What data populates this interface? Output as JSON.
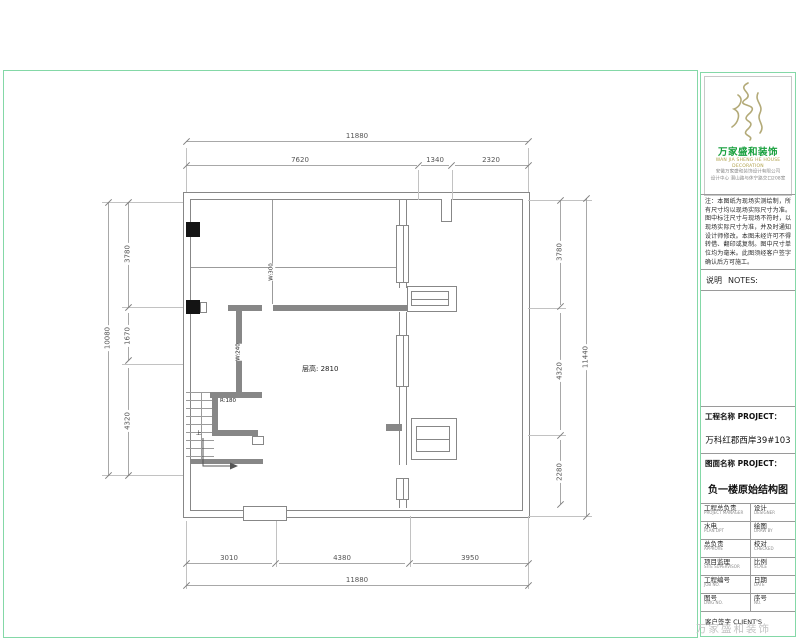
{
  "plan": {
    "dims": {
      "top_total": "11880",
      "top_segs": [
        "7620",
        "1340",
        "2320"
      ],
      "bottom_segs": [
        "3010",
        "4380",
        "3950"
      ],
      "bottom_total": "11880",
      "left_total": "10080",
      "left_segs": [
        "3780",
        "1670",
        "4320"
      ],
      "right_segs": [
        "3780",
        "4320",
        "2280"
      ],
      "right_total": "11440"
    },
    "labels": {
      "floor_height": "层高: 2810",
      "wall_300": "W:300",
      "wall_240": "W:240",
      "stair_rise": "R:180",
      "up": "上"
    }
  },
  "panel": {
    "brand_cn": "万家盛和装饰",
    "brand_en": "WAN JIA SHENG HE HOUSE DECORATION",
    "company_line1": "安徽万家盛和装饰设计有限公司",
    "company_line2": "设计中心 潜山路与休宁路交口208室",
    "notes": "注：本图纸为现场实测绘制，所有尺寸均以现场实际尺寸为准。图中标注尺寸与现场不符时，以现场实际尺寸为准，并及时通知设计师修改。本图未经许可不得转借、翻印或复制。图中尺寸单位均为毫米。此图须经客户签字确认后方可施工。",
    "notes_cn": "说明",
    "notes_en": "NOTES:",
    "project_label": "工程名称 PROJECT：",
    "project_name": "万科红郡西岸39#103",
    "drawing_label": "图面名称 PROJECT：",
    "drawing_name": "负一楼原始结构图",
    "table_rows": [
      {
        "l_cn": "工程总负责",
        "l_en": "PROJECT MANAGER",
        "r_cn": "设计",
        "r_en": "DESIGNER"
      },
      {
        "l_cn": "水电",
        "l_en": "PLAN DPT",
        "r_cn": "绘图",
        "r_en": "DRAW BY"
      },
      {
        "l_cn": "总负责",
        "l_en": "APPROVE",
        "r_cn": "校对",
        "r_en": "CHECKED"
      },
      {
        "l_cn": "项目监理",
        "l_en": "SITE SUPERVISOR",
        "r_cn": "比例",
        "r_en": "SCALE"
      },
      {
        "l_cn": "工程编号",
        "l_en": "JOB NO.",
        "r_cn": "日期",
        "r_en": "DATE"
      },
      {
        "l_cn": "图号",
        "l_en": "DWG NO.",
        "r_cn": "序号",
        "r_en": "NO."
      }
    ],
    "client_row": "客户签字 CLIENT'S",
    "watermark": "万家盛和装饰"
  },
  "colors": {
    "frame_green": "#84d8a7",
    "brand_green": "#18a03e",
    "wall_gray": "#878787"
  }
}
